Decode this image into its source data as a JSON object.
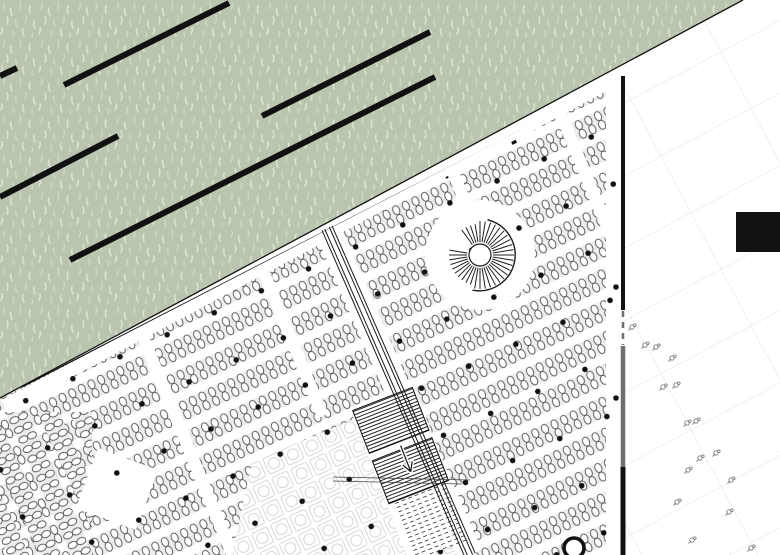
{
  "canvas": {
    "width": 780,
    "height": 555,
    "background": "#ffffff"
  },
  "palette": {
    "ink": "#111111",
    "green_base": "#b9c5ae",
    "grass_light": "#ccd6c1",
    "grass_lighter": "#dce3d0",
    "wall_gray": "#6f6f6f",
    "grid_line": "#e3e3e6",
    "chair_line": "#4d4d4d",
    "band_fill": "#ededed",
    "paving_line": "#d7d7d7",
    "flower_line": "#7f7f7f",
    "stripe_line": "#222222"
  },
  "green_area": {
    "polygon": [
      [
        0,
        0
      ],
      [
        743,
        0
      ],
      [
        0,
        398
      ]
    ],
    "texture": {
      "tile": 38,
      "stroke_width": 1.6,
      "strokes": [
        [
          4,
          3,
          "c1,2 0,4 -1,6",
          0
        ],
        [
          11,
          8,
          "c-1,2 0,5 1,7",
          1
        ],
        [
          20,
          2,
          "c1,3 1,5 0,8",
          0
        ],
        [
          30,
          6,
          "c-1,2 -1,4 0,7",
          1
        ],
        [
          7,
          17,
          "c1,2 1,5 0,7",
          1
        ],
        [
          16,
          20,
          "c-1,2 0,4 1,6",
          0
        ],
        [
          26,
          16,
          "c1,2 0,5 -1,7",
          0
        ],
        [
          34,
          21,
          "c-1,3 0,5 1,7",
          1
        ],
        [
          2,
          28,
          "c1,2 0,4 -1,6",
          1
        ],
        [
          13,
          31,
          "c1,2 1,4 0,6",
          0
        ],
        [
          23,
          29,
          "c-1,2 0,5 1,7",
          1
        ],
        [
          32,
          33,
          "c1,2 0,4 0,6",
          0
        ]
      ]
    },
    "bars": {
      "width": 6,
      "lines": [
        [
          0,
          76,
          17,
          68
        ],
        [
          64,
          85,
          229,
          3
        ],
        [
          262,
          116,
          430,
          32
        ],
        [
          0,
          197,
          118,
          136
        ],
        [
          70,
          260,
          435,
          77
        ]
      ]
    }
  },
  "boundary": {
    "thin": [
      0,
      398,
      743,
      0
    ],
    "thick": [
      22,
      389,
      532,
      127
    ],
    "thick_width": 5,
    "tabs": {
      "t": [
        0.05,
        0.18,
        0.31,
        0.44,
        0.57,
        0.7,
        0.83,
        0.96
      ],
      "size": 5,
      "offset": 4.5
    }
  },
  "seating": {
    "clip": [
      [
        0,
        399
      ],
      [
        623,
        77
      ],
      [
        623,
        555
      ],
      [
        0,
        555
      ]
    ],
    "chairs": {
      "angle": -25,
      "pitch": 10.6,
      "band_pitch": 29,
      "row_y": [
        10,
        19.5
      ],
      "rx": 3.3,
      "ry": 4.7,
      "stroke_width": 0.9,
      "band_strip": [
        5,
        19.5
      ]
    },
    "steep_patch": {
      "rect": [
        0,
        412,
        92,
        143
      ],
      "angle": 65
    },
    "dots": {
      "angle": -25,
      "spacing": 52,
      "radius": 2.8
    },
    "margins": {
      "top_line": [
        4,
        406,
        748,
        8
      ],
      "top_width": 13,
      "wall_rect": [
        606,
        60,
        17,
        495
      ]
    },
    "aisles": {
      "width": 12,
      "dir": [
        0.38,
        0.925
      ],
      "items": [
        [
          140,
          330,
          250
        ],
        [
          262,
          268,
          160
        ],
        [
          452,
          170,
          75
        ],
        [
          560,
          112,
          215
        ]
      ]
    },
    "plaza_clear_radius": 55,
    "diamond": [
      [
        158,
        470
      ],
      [
        136,
        530
      ],
      [
        76,
        508
      ],
      [
        98,
        448
      ]
    ]
  },
  "sunburst": {
    "cx": 480,
    "cy": 255,
    "inner_r": 11,
    "spoke_in": 13,
    "spoke_out": 34,
    "spoke_out_left": 31,
    "outer_r": 36,
    "count": 40,
    "gap_deg": [
      192,
      228
    ],
    "left_deg": [
      100,
      262
    ]
  },
  "path": {
    "line": [
      327,
      228,
      470,
      555
    ],
    "offsets": [
      -5.5,
      -2.5,
      2.5,
      5.5
    ],
    "clear_width": 26
  },
  "ramp": {
    "top_center": [
      382.5,
      399
    ],
    "dir": [
      0.362,
      0.931
    ],
    "half_width": 32,
    "solid_sections": [
      [
        0,
        46
      ],
      [
        54,
        100
      ]
    ],
    "dashed_section": [
      100,
      162
    ],
    "white_quad": [
      0,
      162
    ],
    "stripe_step": 3.4,
    "dash_step": 4.6,
    "dash_half_width": 27,
    "arrow": {
      "s1": 50,
      "s2": 78,
      "back": 9,
      "wing": 5
    }
  },
  "section_lines": [
    [
      333,
      477,
      470,
      480
    ],
    [
      333,
      481,
      462,
      484
    ]
  ],
  "paving": {
    "polygon": [
      [
        252,
        462
      ],
      [
        352,
        420
      ],
      [
        458,
        555
      ],
      [
        232,
        555
      ]
    ],
    "tile": 21,
    "angle": -25
  },
  "bold_circle": {
    "cx": 574,
    "cy": 548,
    "r": 10,
    "stroke_width": 3.6
  },
  "wall": {
    "x": 623,
    "segments": [
      [
        76,
        310,
        "ink",
        4,
        ""
      ],
      [
        311,
        345,
        "wall_gray",
        2.5,
        "6,5"
      ],
      [
        346,
        467,
        "wall_gray",
        4.5,
        ""
      ],
      [
        467,
        555,
        "ink",
        5,
        ""
      ]
    ],
    "dots": [
      [
        616,
        287
      ],
      [
        616,
        398
      ]
    ],
    "dot_r": 2.8
  },
  "right_band": {
    "rect": [
      620,
      0,
      160,
      555
    ],
    "grid": {
      "w": 102,
      "h": 64,
      "angle": -28
    },
    "black_rect": [
      736,
      212,
      44,
      40
    ],
    "flowers": [
      [
        632,
        327
      ],
      [
        645,
        345
      ],
      [
        656,
        347
      ],
      [
        672,
        358
      ],
      [
        663,
        387
      ],
      [
        676,
        385
      ],
      [
        687,
        423
      ],
      [
        696,
        421
      ],
      [
        688,
        470
      ],
      [
        700,
        458
      ],
      [
        716,
        453
      ],
      [
        731,
        480
      ],
      [
        677,
        502
      ],
      [
        729,
        512
      ],
      [
        692,
        540
      ],
      [
        751,
        548
      ]
    ]
  }
}
